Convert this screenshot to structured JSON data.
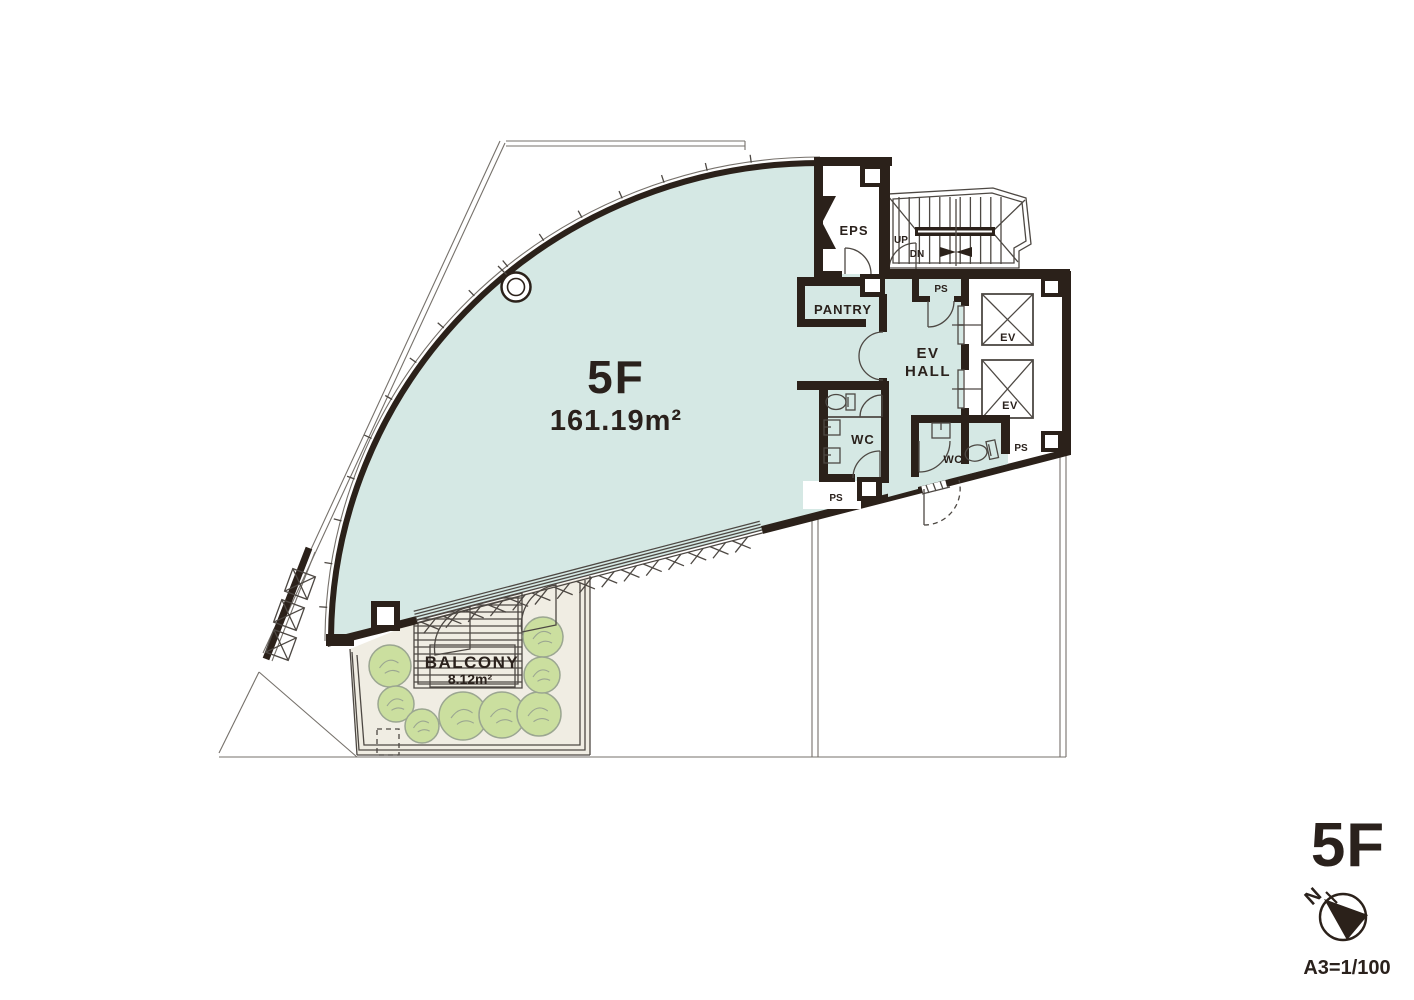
{
  "plan": {
    "main_room": {
      "name": "5F",
      "area": "161.19m²"
    },
    "balcony": {
      "name": "BALCONY",
      "area": "8.12m²"
    },
    "labels": {
      "eps": "EPS",
      "pantry": "PANTRY",
      "ev_hall_1": "EV",
      "ev_hall_2": "HALL",
      "wc_left": "WC",
      "wc_right": "WC",
      "ps_stair": "PS",
      "ps_lower_left": "PS",
      "ps_lower_right": "PS",
      "ev_upper": "EV",
      "ev_lower": "EV",
      "up": "UP",
      "down": "DN"
    }
  },
  "title_block": {
    "floor": "5F",
    "scale": "A3=1/100",
    "north": "N"
  },
  "colors": {
    "room_fill": "#d5e8e4",
    "wall": "#2b211a",
    "line": "#4d4843",
    "site_line": "#76716b",
    "balcony_ground": "#f0ede3",
    "deck": "#f6f4ed",
    "bush": "#cbdf9f",
    "bush_outline": "#9ba691",
    "text": "#2a211c"
  }
}
